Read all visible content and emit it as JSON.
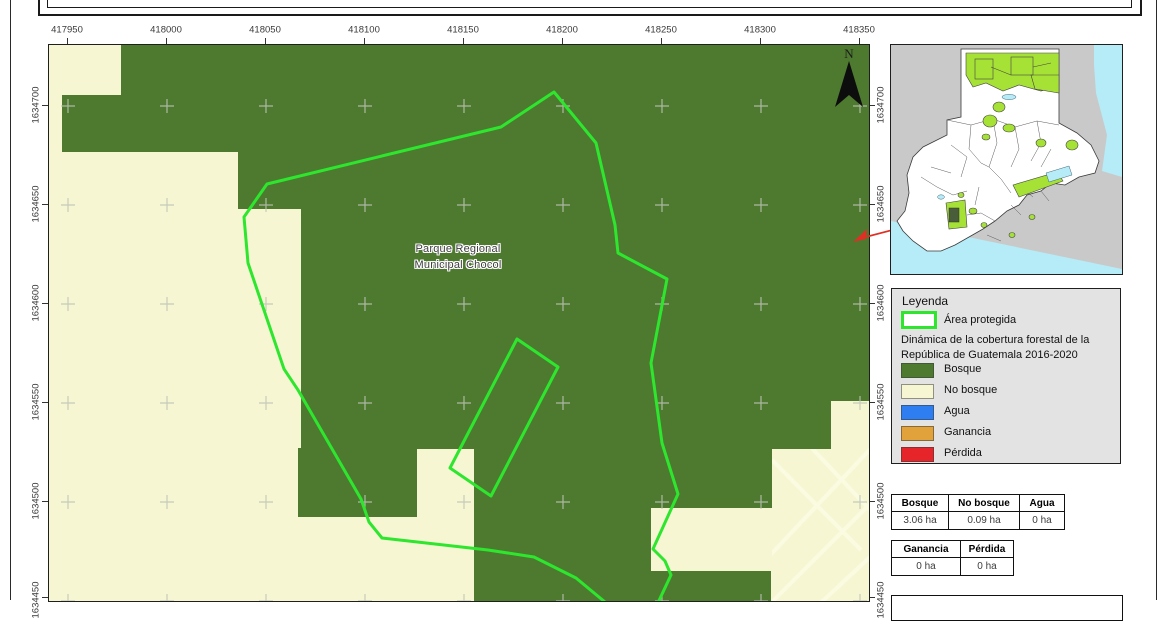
{
  "map": {
    "x_labels": [
      "417950",
      "418000",
      "418050",
      "418100",
      "418150",
      "418200",
      "418250",
      "418300",
      "418350"
    ],
    "y_labels": [
      "1634700",
      "1634650",
      "1634600",
      "1634550",
      "1634500",
      "1634450"
    ],
    "park_label_line1": "Parque Regional",
    "park_label_line2": "Municipal Chocol",
    "north_label": "N"
  },
  "legend": {
    "title": "Leyenda",
    "protected_area": {
      "label": "Área protegida",
      "outline_color": "#2ee62e"
    },
    "subtitle_line1": "Dinámica de la cobertura forestal de la",
    "subtitle_line2": "República de Guatemala 2016-2020",
    "items": [
      {
        "label": "Bosque",
        "color": "#4d7a2f"
      },
      {
        "label": "No bosque",
        "color": "#f6f7d2"
      },
      {
        "label": "Agua",
        "color": "#2e7ef2"
      },
      {
        "label": "Ganancia",
        "color": "#e2a23b"
      },
      {
        "label": "Pérdida",
        "color": "#e5252a"
      }
    ]
  },
  "tables": {
    "coverage": {
      "headers": [
        "Bosque",
        "No bosque",
        "Agua"
      ],
      "values": [
        "3.06 ha",
        "0.09 ha",
        "0 ha"
      ]
    },
    "change": {
      "headers": [
        "Ganancia",
        "Pérdida"
      ],
      "values": [
        "0 ha",
        "0 ha"
      ]
    }
  },
  "colors": {
    "bosque": "#4d7a2f",
    "no_bosque": "#f6f7d2",
    "protected_outline": "#2ee62e",
    "inset_protected": "#a6e135",
    "inset_water": "#b5ecf7",
    "inset_neighbors": "#c9c9c9",
    "leader_line": "#e03025"
  }
}
